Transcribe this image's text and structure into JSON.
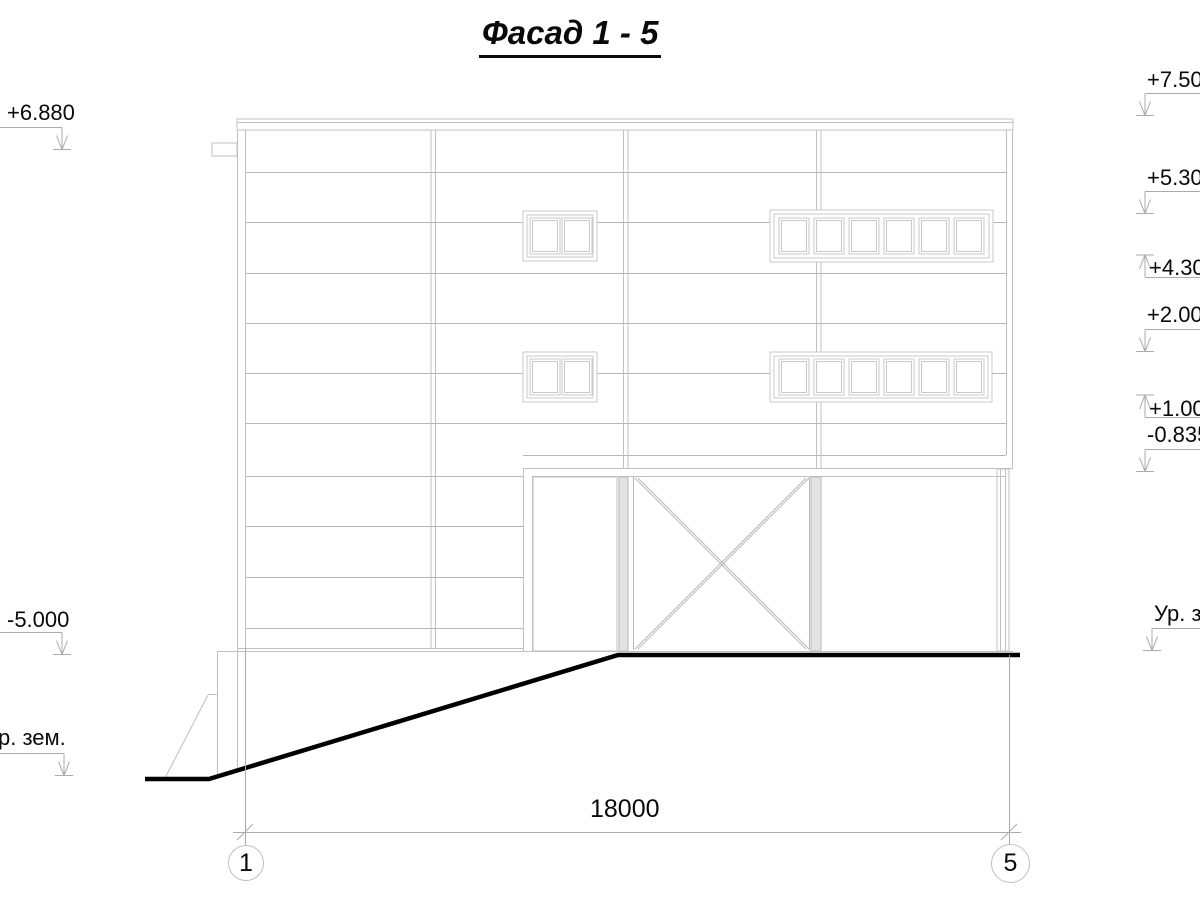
{
  "title": "Фасад 1 - 5",
  "elevation_marks_left": [
    {
      "label": "+6.880"
    },
    {
      "label": "-5.000"
    },
    {
      "label": "Ур. зем."
    }
  ],
  "elevation_marks_right": [
    {
      "label": "+7.500"
    },
    {
      "label": "+5.300"
    },
    {
      "label": "+4.300"
    },
    {
      "label": "+2.000"
    },
    {
      "label": "+1.000"
    },
    {
      "label": "-0.835"
    },
    {
      "label": "Ур. зем."
    }
  ],
  "dimension": {
    "length_label": "18000"
  },
  "axis_markers": [
    {
      "label": "1"
    },
    {
      "label": "5"
    }
  ],
  "colors": {
    "building_line": "#c0c0c0",
    "siding_line": "#b6b6b6",
    "annotation_line": "#ababab",
    "ground_line": "#000000",
    "text": "#0a0a0a"
  }
}
